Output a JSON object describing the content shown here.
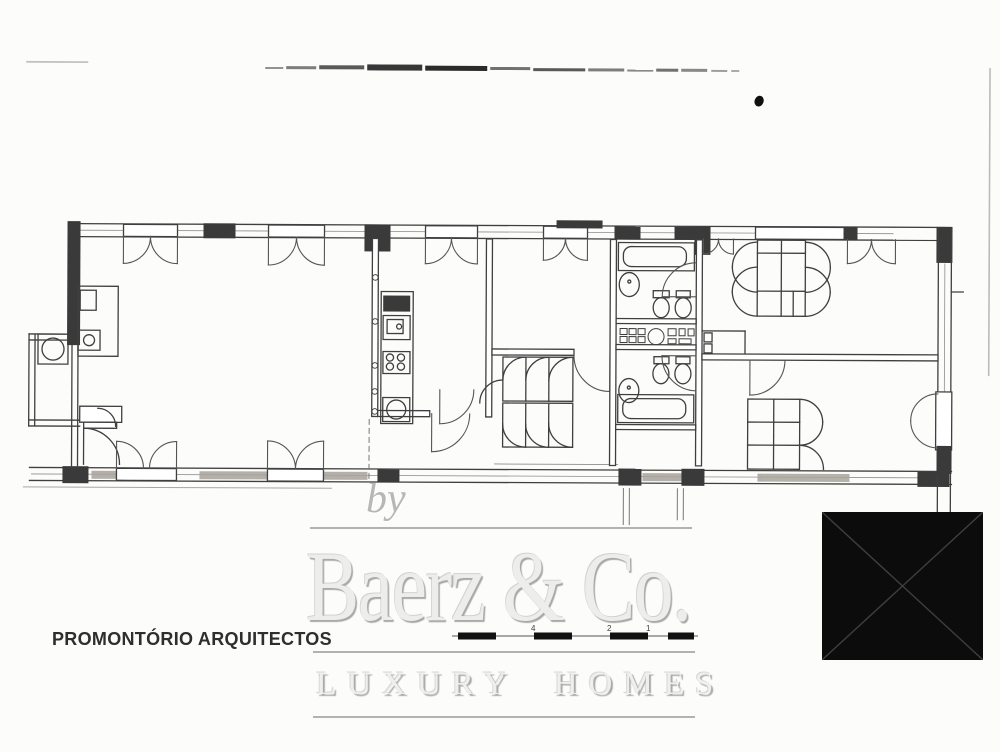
{
  "branding": {
    "by_label": "by",
    "company_name": "Baerz & Co.",
    "tagline": "LUXURY HOMES"
  },
  "architect": {
    "name": "PROMONTÓRIO ARQUITECTOS"
  },
  "scale_bar": {
    "tick_labels": [
      "4",
      "2",
      "1"
    ]
  },
  "colors": {
    "plan_ink": "#3f3f3f",
    "wall_pier": "#3a3a3a",
    "window_hatch": "#a8a39c",
    "watermark_gray": "#bcbcbc",
    "architect_text": "#2e2e2e",
    "blackout_square": "#0c0c0c"
  }
}
